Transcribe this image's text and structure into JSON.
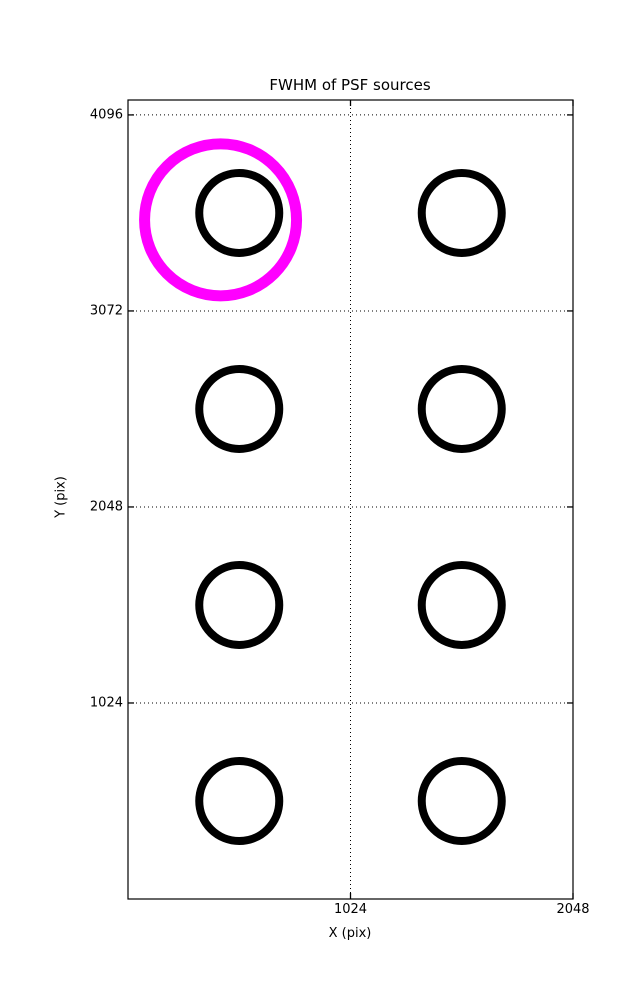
{
  "chart_data": {
    "type": "scatter",
    "title": "FWHM of PSF sources",
    "xlabel": "X (pix)",
    "ylabel": "Y (pix)",
    "xlim": [
      0,
      2048
    ],
    "ylim": [
      0,
      4174
    ],
    "xticks": [
      1024,
      2048
    ],
    "yticks": [
      1024,
      2048,
      3072,
      4096
    ],
    "grid": {
      "visible": true,
      "style": "dotted",
      "color": "#000000"
    },
    "tick_direction": "in",
    "axes_color": "#000000",
    "background_color": "#ffffff",
    "sources": [
      {
        "x": 512,
        "y": 3584
      },
      {
        "x": 1536,
        "y": 3584
      },
      {
        "x": 512,
        "y": 2560
      },
      {
        "x": 1536,
        "y": 2560
      },
      {
        "x": 512,
        "y": 1536
      },
      {
        "x": 1536,
        "y": 1536
      },
      {
        "x": 512,
        "y": 512
      },
      {
        "x": 1536,
        "y": 512
      }
    ],
    "source_marker": {
      "shape": "circle",
      "radius_px": 40,
      "stroke_px": 8,
      "color": "#000000"
    },
    "highlight_marker": {
      "shape": "circle",
      "x": 426,
      "y": 3548,
      "radius_px": 76,
      "stroke_px": 11,
      "color": "#ff00ff"
    }
  }
}
